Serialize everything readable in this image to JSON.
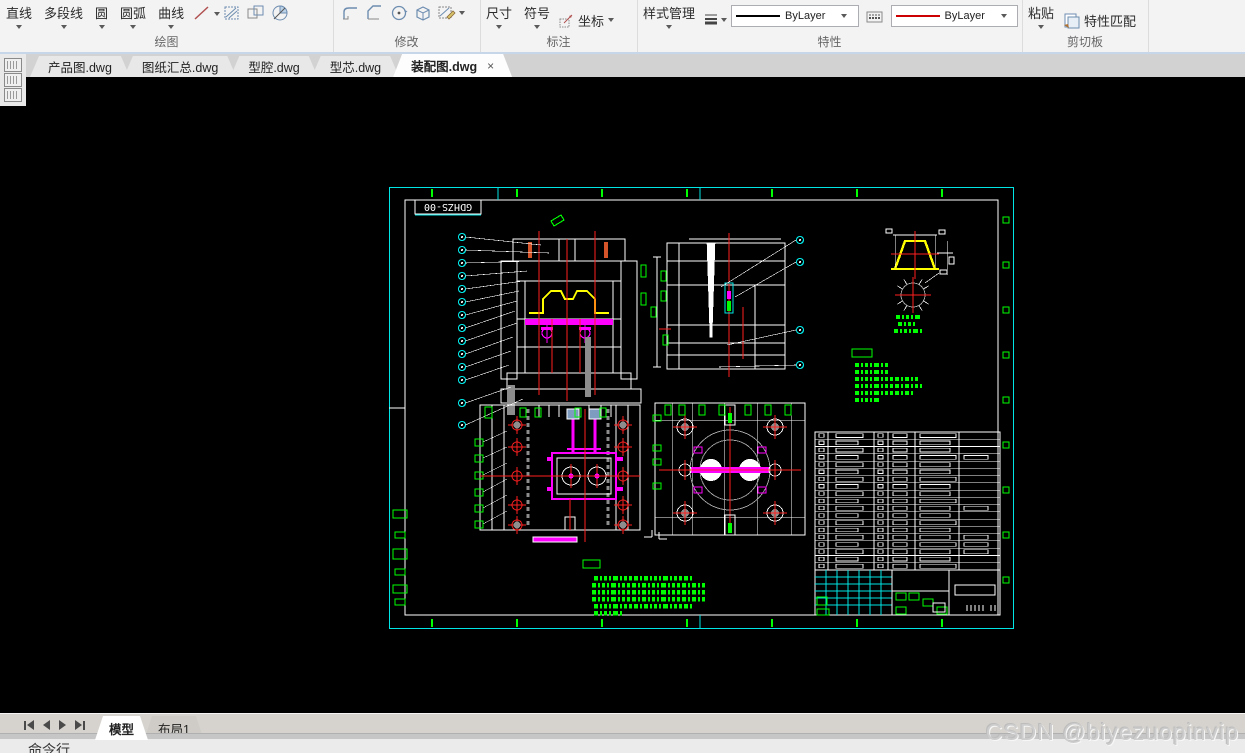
{
  "ribbon": {
    "groups": {
      "draw": {
        "label": "绘图",
        "buttons": [
          "直线",
          "多段线",
          "圆",
          "圆弧",
          "曲线"
        ]
      },
      "modify": {
        "label": "修改"
      },
      "annotate": {
        "label": "标注",
        "buttons": [
          "尺寸",
          "符号",
          "坐标"
        ]
      },
      "properties": {
        "label": "特性",
        "style_manager": "样式管理",
        "linetype_value": "ByLayer",
        "linetype_color": "#000000",
        "color_value": "ByLayer",
        "color_sample": "#cc0000"
      },
      "clipboard": {
        "label": "剪切板",
        "paste": "粘贴",
        "match_props": "特性匹配"
      }
    }
  },
  "file_tabs": [
    {
      "label": "产品图.dwg"
    },
    {
      "label": "图纸汇总.dwg"
    },
    {
      "label": "型腔.dwg"
    },
    {
      "label": "型芯.dwg"
    },
    {
      "label": "装配图.dwg",
      "close": "×"
    }
  ],
  "drawing": {
    "frame_label": "GDHZS-00",
    "bom_rows": 19,
    "balloons_left": 14,
    "balloons_right": 4,
    "accent_colors": {
      "border": "#00e5e5",
      "marks": "#00ff00",
      "centerline": "#ff2020",
      "part_profile": "#ffff00",
      "runner": "#ff00ff"
    }
  },
  "status_bar": {
    "model_tab": "模型",
    "layout_tab": "布局1"
  },
  "command_line": {
    "label": "命令行"
  },
  "watermark": "CSDN @biyezuopinvip"
}
